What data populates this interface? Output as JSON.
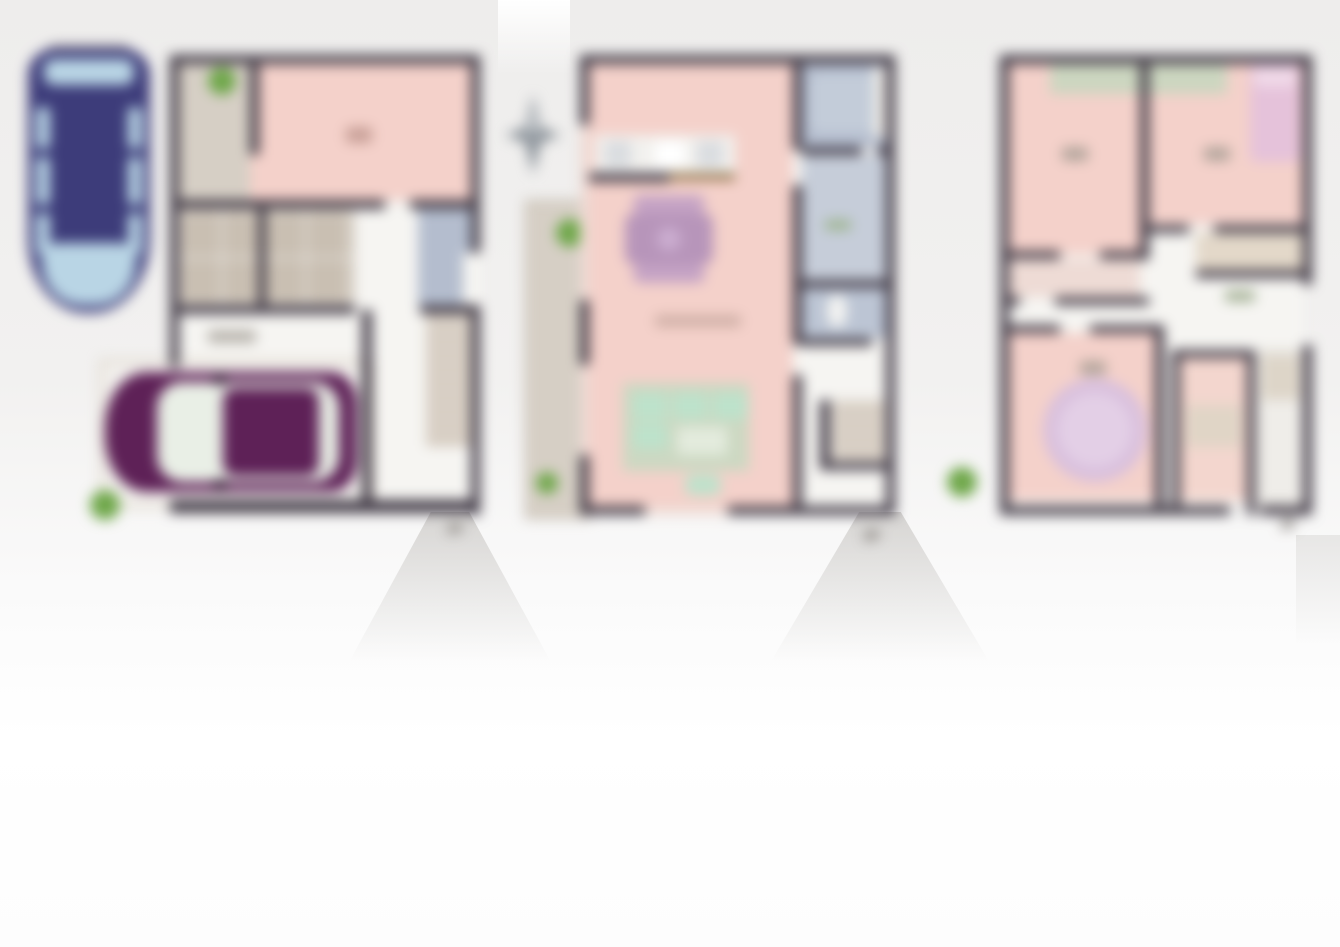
{
  "image": {
    "type": "real-estate 3-storey floor plan render, heavily blurred",
    "floors": [
      {
        "label": "1F"
      },
      {
        "label": "2F"
      },
      {
        "label": "3F"
      }
    ],
    "objects": {
      "vehicles": [
        {
          "name": "minivan-top-view",
          "body_color": "#3d3c7a",
          "glass_color": "#b9d5e5"
        },
        {
          "name": "sedan-top-view",
          "body_color": "#5e2157",
          "glass_color": "#e9efe6"
        }
      ],
      "compass_star": {
        "color": "#8f969d"
      },
      "shrub_count": 5
    },
    "colors": {
      "background": "#f1f0ee",
      "wall": "#413a46",
      "room_pink": "#f4d1ca",
      "balcony_beige": "#d6cfc5",
      "storage_tan": "#c9bfb2",
      "wet_area_blue": "#b4bdce",
      "wet_area_blue_light": "#c6cdd9",
      "floor_white": "#f6f5f2",
      "shrub_green": "#6fa74a",
      "dining_purple": "#b795ba",
      "sofa_mint": "#bde2cb",
      "rug_sage": "#ccd8c2",
      "bed_pink": "#e5c2da",
      "round_rug_lavender": "#d9c0dd",
      "counter_brown": "#8a6b3f"
    }
  }
}
